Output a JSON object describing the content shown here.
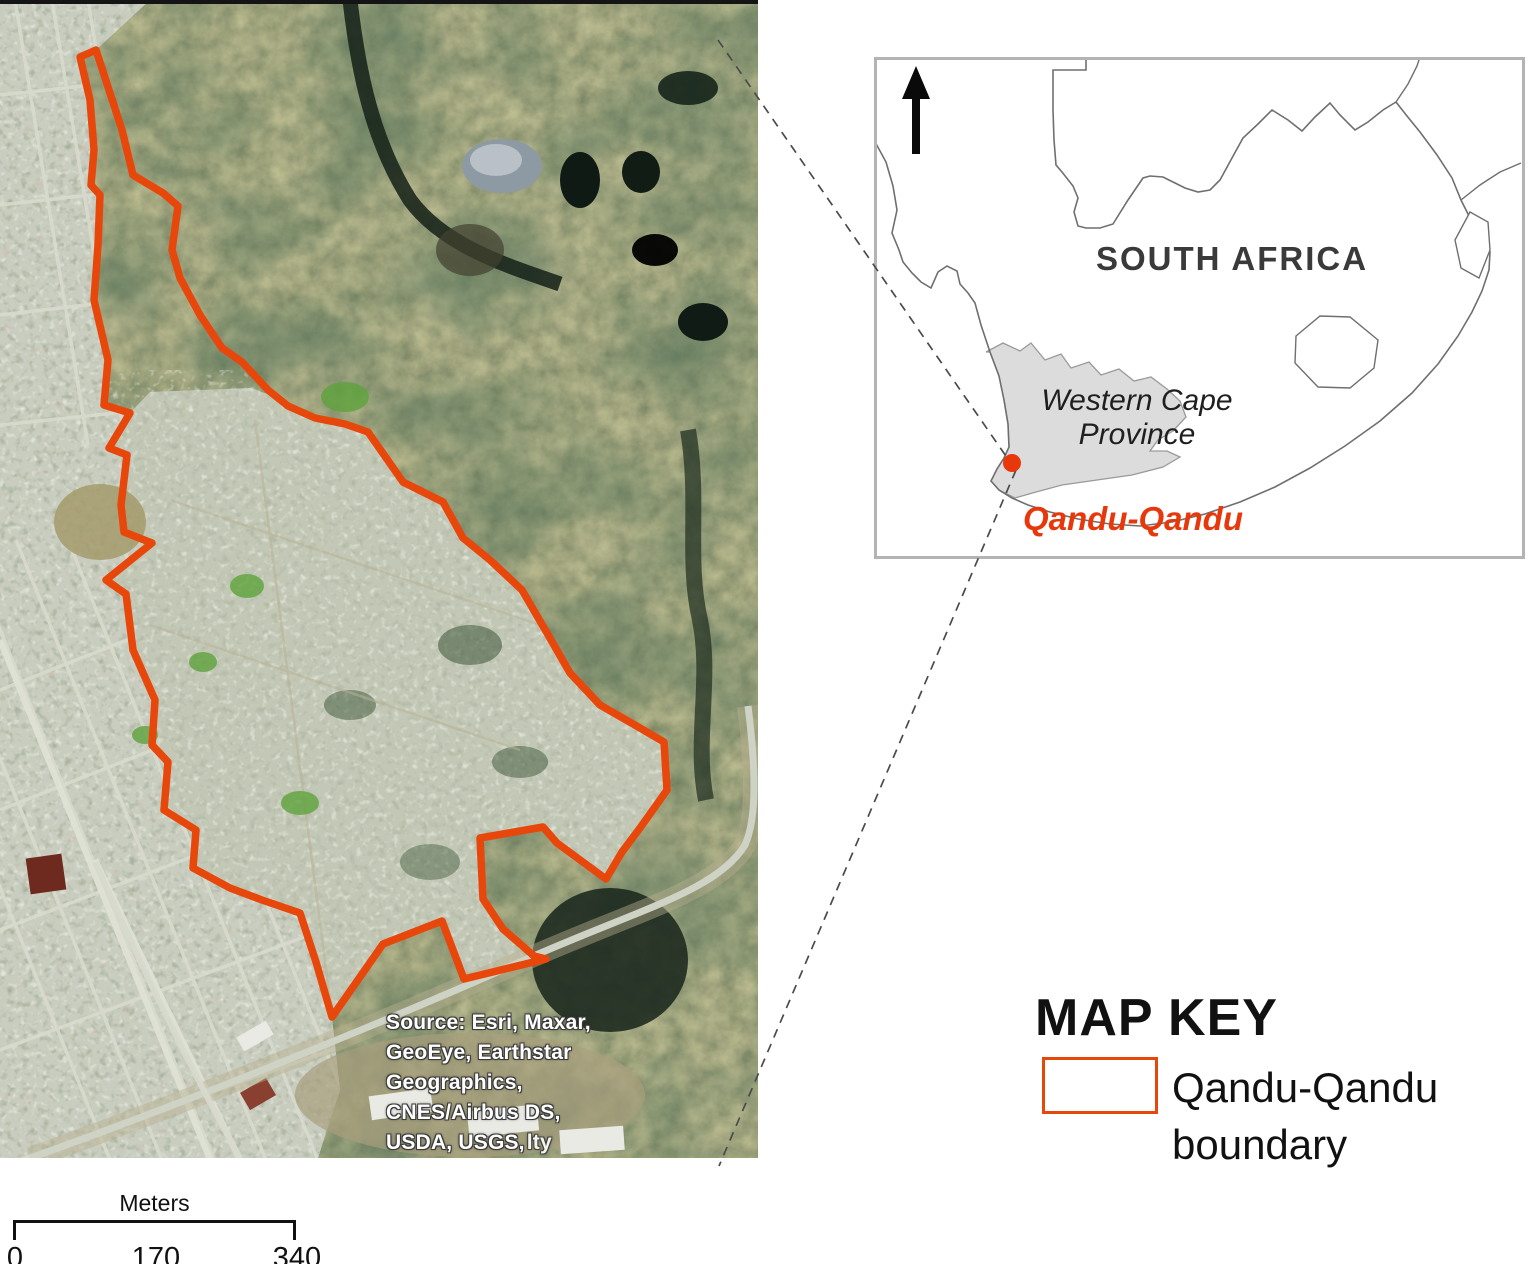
{
  "colors": {
    "boundary": "#e8470b",
    "location_accent": "#e8380b",
    "province_fill": "#dcdcdc"
  },
  "satellite": {
    "boundary_points": "80,57 96,50 122,130 133,175 163,193 178,206 172,250 180,278 200,315 222,348 242,362 268,390 288,406 315,418 345,424 368,432 403,482 443,502 463,538 490,560 522,590 547,633 570,673 600,705 640,728 664,742 667,790 640,828 622,852 606,879 557,843 543,827 480,838 483,899 503,929 534,956 546,959 464,979 442,921 383,944 332,1017 316,962 300,913 262,900 230,888 193,868 196,830 164,810 168,762 152,745 155,700 133,650 126,594 106,580 152,543 124,532 121,505 127,455 109,448 130,413 104,405 108,360 94,300 98,245 100,195 91,185 94,150 90,100",
    "source_lines": [
      "Source: Esri, Maxar,",
      "GeoEye, Earthstar",
      "Geographics,",
      "CNES/Airbus DS,",
      "USDA, USGS,"
    ],
    "source_overlap": "lty"
  },
  "inset": {
    "country_label": "SOUTH AFRICA",
    "province_label_line1": "Western Cape",
    "province_label_line2": "Province",
    "location_label": "Qandu-Qandu"
  },
  "map_key": {
    "title": "MAP KEY",
    "legend_label": "Qandu-Qandu boundary"
  },
  "scale_bar": {
    "unit_label": "Meters",
    "ticks": [
      "0",
      "170",
      "340"
    ]
  }
}
